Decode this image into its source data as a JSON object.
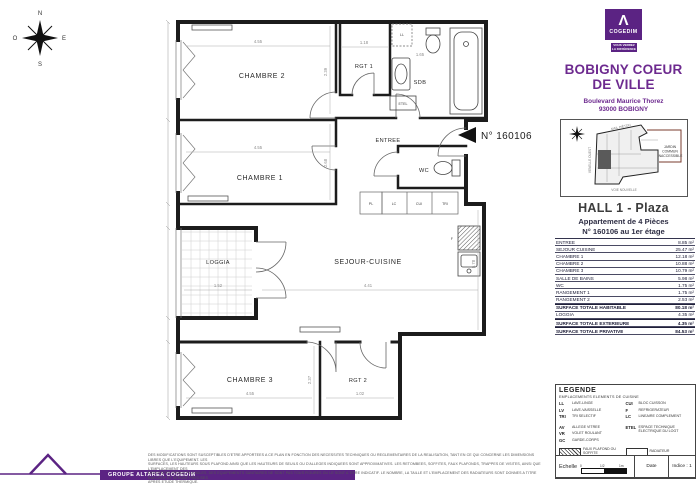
{
  "colors": {
    "brand_purple": "#5b2383",
    "title_purple": "#6d2a8f",
    "plan_line": "#1c1c1c"
  },
  "compass": {
    "n": "N",
    "e": "E",
    "s": "S",
    "o": "O"
  },
  "plan": {
    "unit_label": "N° 160106",
    "rooms": {
      "chambre2": "CHAMBRE 2",
      "chambre1": "CHAMBRE 1",
      "chambre3": "CHAMBRE 3",
      "rgt1": "RGT 1",
      "rgt2": "RGT 2",
      "sdb": "SDB",
      "entree": "ENTREE",
      "wc": "WC",
      "loggia": "LOGGIA",
      "sejour": "SEJOUR-CUISINE"
    },
    "annotations": {
      "etel": "ETEL",
      "ll": "LL",
      "pl": "PL",
      "lc": "LC",
      "cui": "CUI",
      "tri": "TRI",
      "f": "F"
    },
    "dims": {
      "chambre2_w": "4.55",
      "chambre2_h": "2.39",
      "rgt1_w": "1.18",
      "sdb_w": "1.65",
      "chambre1_w": "4.55",
      "chambre1_h": "2.68",
      "loggia_w": "1.52",
      "sejour_w": "4.41",
      "sejour_h": "5.78",
      "chambre3_w": "4.55",
      "chambre3_h": "2.37",
      "rgt2_w": "1.02"
    }
  },
  "panel": {
    "logo": {
      "mark": "Λ",
      "brand": "COGEDIM",
      "tagline_1": "VOUS VERREZ",
      "tagline_2": "LA DIFFÉRENCE"
    },
    "project": {
      "title_1": "BOBIGNY COEUR",
      "title_2": "DE VILLE",
      "address_1": "Boulevard Maurice Thorez",
      "address_2": "93000 BOBIGNY"
    },
    "siteplan": {
      "jardin_1": "JARDIN",
      "jardin_2": "COMMUN",
      "jardin_3": "INACCESSIBLE",
      "street_top": "MAIL PIÉTON",
      "street_left": "VENELLE OUEST",
      "street_bottom": "VOIE NOUVELLE"
    },
    "unit": {
      "hall": "HALL 1 - Plaza",
      "type": "Appartement de 4 Pièces",
      "number": "N° 160106 au 1er étage"
    },
    "areas": {
      "rows": [
        {
          "label": "ENTREE",
          "value": "8.85 m²"
        },
        {
          "label": "SEJOUR CUISINE",
          "value": "25.47 m²"
        },
        {
          "label": "CHAMBRE 1",
          "value": "12.18 m²"
        },
        {
          "label": "CHAMBRE 2",
          "value": "10.88 m²"
        },
        {
          "label": "CHAMBRE 3",
          "value": "10.79 m²"
        },
        {
          "label": "SALLE DE BAINS",
          "value": "5.98 m²"
        },
        {
          "label": "WC",
          "value": "1.75 m²"
        },
        {
          "label": "RANGEMENT 1",
          "value": "1.75 m²"
        },
        {
          "label": "RANGEMENT 2",
          "value": "2.53 m²"
        },
        {
          "label": "SURFACE TOTALE HABITABLE",
          "value": "80.18 m²"
        },
        {
          "label": "LOGGIA",
          "value": "4.35 m²"
        },
        {
          "label": "SURFACE TOTALE EXTERIEURE",
          "value": "4.35 m²"
        },
        {
          "label": "SURFACE TOTALE PRIVATIVE",
          "value": "84.53 m²"
        }
      ]
    },
    "legend": {
      "title": "LEGENDE",
      "subtitle": "EMPLACEMENTS ELEMENTS DE CUISINE",
      "abbr_left": [
        {
          "k": "LL",
          "v": "LAVE-LINGE"
        },
        {
          "k": "LV",
          "v": "LAVE-VAISSELLE"
        },
        {
          "k": "TRI",
          "v": "TRI SELECTIF"
        },
        {
          "k": "AV",
          "v": "ALLEGE VITREE"
        },
        {
          "k": "VR",
          "v": "VOLET ROULANT"
        },
        {
          "k": "GC",
          "v": "GARDE-CORPS"
        }
      ],
      "abbr_right": [
        {
          "k": "CUI",
          "v": "BLOC CUISSON"
        },
        {
          "k": "F",
          "v": "REFRIGERATEUR"
        },
        {
          "k": "LC",
          "v": "LINEAIRE COMPLEMENT"
        },
        {
          "k": "ETEL",
          "v": "ESPACE TECHNIQUE ÉLECTRIQUE DU LOGT"
        }
      ],
      "swatch_faux": "FAUX PLAFOND OU SOFFITE",
      "swatch_poutre": "RETOMBEE DE POUTRE",
      "swatch_radiateur": "RADIATEUR",
      "swatch_seche": "SECHE-SERVIETTE",
      "note": "Hauteur sous plafond des pièces principales sauf mention particulière : 2.50 m",
      "scale_label": "Echelle",
      "scale_0": "0",
      "scale_half": "1/2",
      "scale_1": "1m",
      "date_label": "Date",
      "indice": "Indice : 1"
    }
  },
  "footer": {
    "brand": "GROUPE ALTAREA COGEDIM",
    "disclaimer_lines": [
      "DES MODIFICATIONS SONT SUSCEPTIBLES D'ETRE APPORTEES A CE PLAN EN FONCTION DES NECESSITES TECHNIQUES OU REGLEMENTAIRES DE LA REALISATION, TANT EN CE QUI CONCERNE LES DIMENSIONS LIBRES QUE L'EQUIPEMENT. LES",
      "SURFACES, LES HAUTEURS SOUS PLAFOND AINSI QUE LES HAUTEURS DE SEUILS OU D'ALLEGES INDIQUEES SONT APPROXIMATIVES. LES RETOMBEES, SOFFITES, FAUX PLAFONDS, TRAPPES DE VISITES, AINSI QUE L'EMPLACEMENT DES",
      "DESCENTES D'EAUX PLUVIALES, DES EQUIPEMENTS SANITAIRES NE SONT PAS TOUS FIGURES OU LE SONT A TITRE INDICATIF. LE NOMBRE, LA TAILLE ET L'EMPLACEMENT DES RADIATEURS SONT DONNES A TITRE INDICATIF ET SERONT PRECISES",
      "APRES ETUDE THERMIQUE."
    ]
  }
}
